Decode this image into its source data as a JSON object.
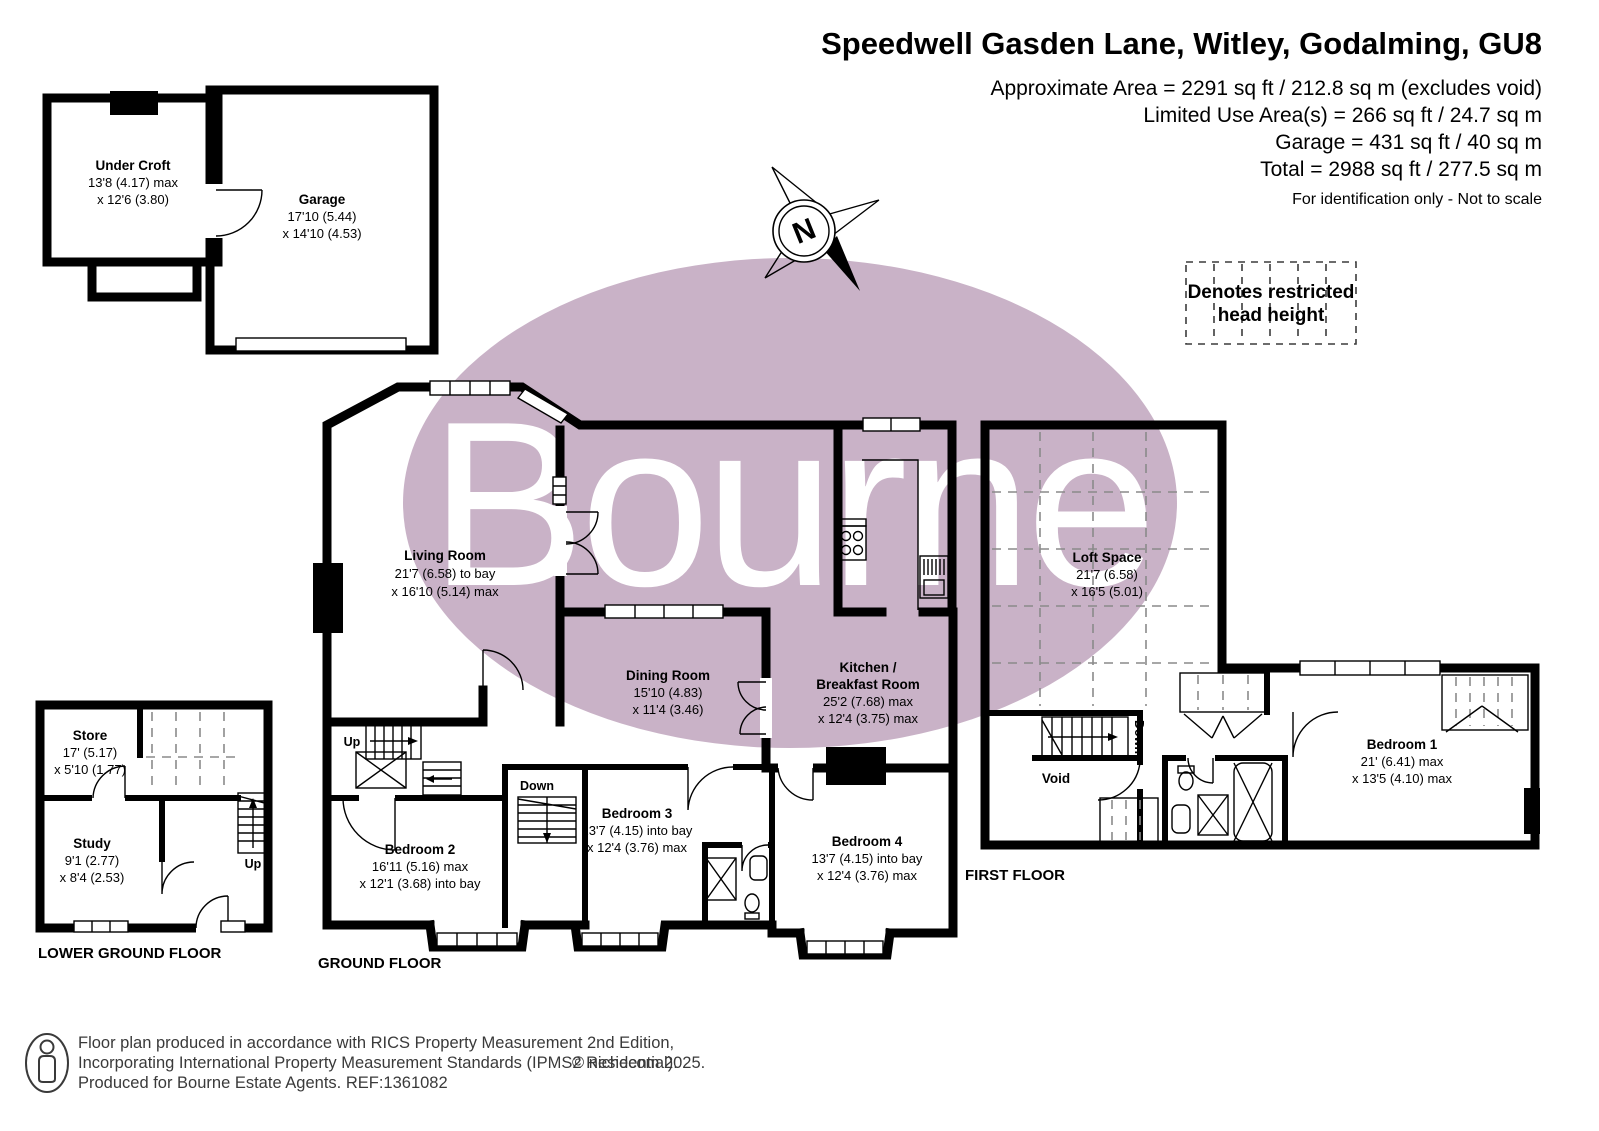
{
  "header": {
    "title": "Speedwell Gasden Lane, Witley, Godalming, GU8",
    "area_lines": [
      "Approximate Area = 2291 sq ft / 212.8 sq m (excludes void)",
      "Limited Use Area(s) = 266 sq ft / 24.7 sq m",
      "Garage = 431 sq ft / 40 sq m",
      "Total = 2988 sq ft / 277.5 sq m"
    ],
    "note": "For identification only - Not to scale"
  },
  "legend": {
    "line1": "Denotes restricted",
    "line2": "head height"
  },
  "compass": {
    "north": "N"
  },
  "watermark": {
    "text": "Bourne"
  },
  "colors": {
    "watermark_ellipse": "#c9b2c7",
    "walls": "#000000",
    "dashed": "#8a8a8a"
  },
  "plans": {
    "garage_block": {
      "under_croft": {
        "name": "Under Croft",
        "dim1": "13'8 (4.17) max",
        "dim2": "x 12'6 (3.80)"
      },
      "garage": {
        "name": "Garage",
        "dim1": "17'10 (5.44)",
        "dim2": "x 14'10 (4.53)"
      }
    },
    "lower_ground": {
      "label": "LOWER GROUND FLOOR",
      "store": {
        "name": "Store",
        "dim1": "17' (5.17)",
        "dim2": "x 5'10 (1.77)"
      },
      "study": {
        "name": "Study",
        "dim1": "9'1 (2.77)",
        "dim2": "x 8'4 (2.53)"
      },
      "up": "Up"
    },
    "ground": {
      "label": "GROUND FLOOR",
      "living": {
        "name": "Living Room",
        "dim1": "21'7 (6.58) to bay",
        "dim2": "x 16'10 (5.14) max"
      },
      "dining": {
        "name": "Dining Room",
        "dim1": "15'10 (4.83)",
        "dim2": "x 11'4 (3.46)"
      },
      "kitchen": {
        "name1": "Kitchen /",
        "name2": "Breakfast Room",
        "dim1": "25'2 (7.68) max",
        "dim2": "x 12'4 (3.75) max"
      },
      "bedroom2": {
        "name": "Bedroom 2",
        "dim1": "16'11 (5.16) max",
        "dim2": "x 12'1 (3.68) into bay"
      },
      "bedroom3": {
        "name": "Bedroom 3",
        "dim1": "13'7 (4.15) into bay",
        "dim2": "x 12'4 (3.76) max"
      },
      "bedroom4": {
        "name": "Bedroom 4",
        "dim1": "13'7 (4.15) into bay",
        "dim2": "x 12'4 (3.76) max"
      },
      "up": "Up",
      "down": "Down"
    },
    "first": {
      "label": "FIRST FLOOR",
      "loft": {
        "name": "Loft Space",
        "dim1": "21'7 (6.58)",
        "dim2": "x 16'5 (5.01)"
      },
      "void": {
        "name": "Void"
      },
      "bedroom1": {
        "name": "Bedroom 1",
        "dim1": "21' (6.41) max",
        "dim2": "x 13'5 (4.10) max"
      },
      "down": "Down"
    }
  },
  "footer": {
    "line1": "Floor plan produced in accordance with RICS Property Measurement 2nd Edition,",
    "line2": "Incorporating International Property Measurement Standards (IPMS2 Residential).",
    "copyright": "© nichecom 2025.",
    "line3": "Produced for Bourne Estate Agents.   REF:1361082"
  }
}
